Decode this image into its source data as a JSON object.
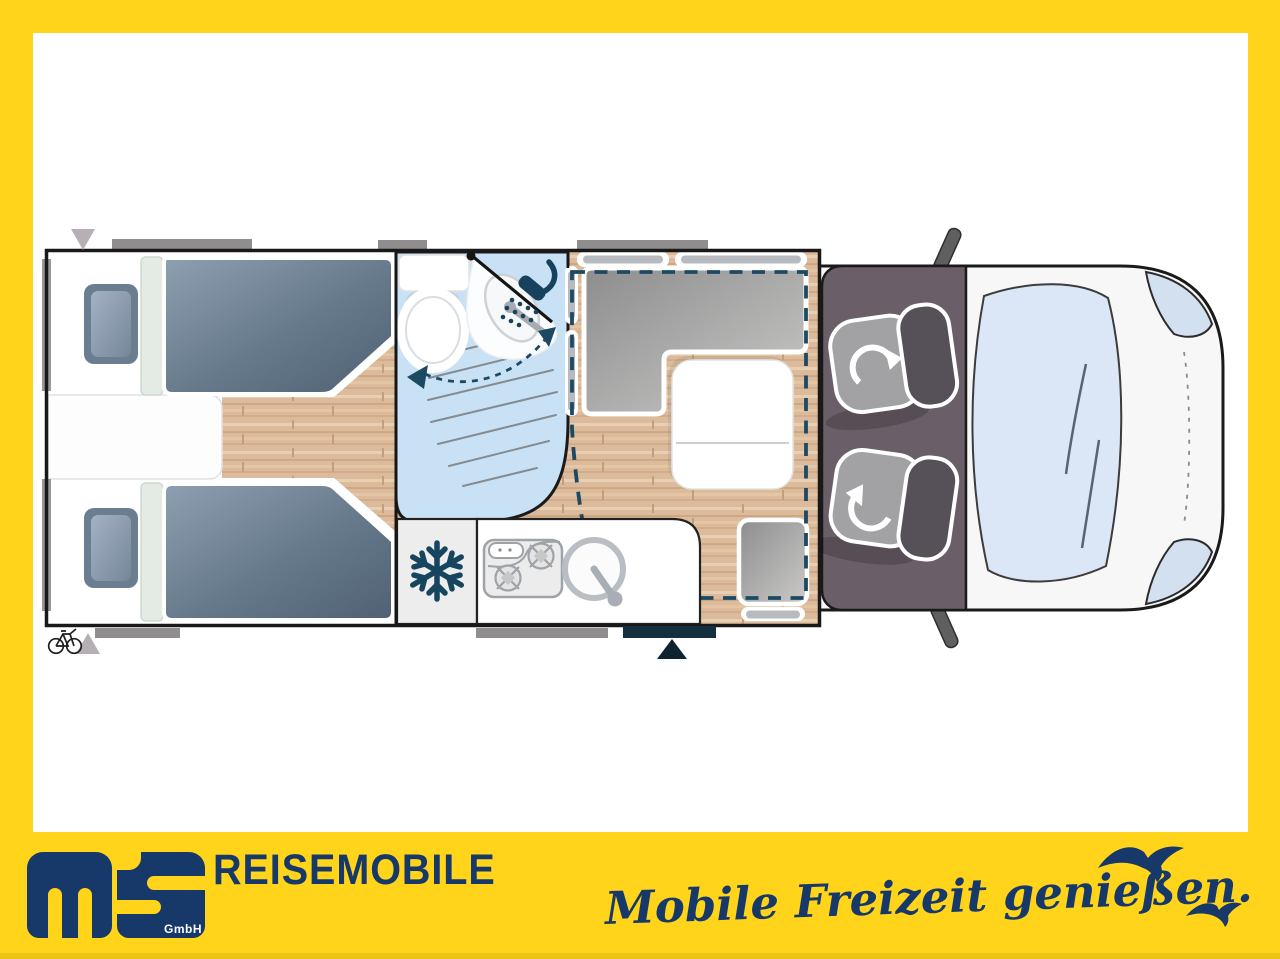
{
  "branding": {
    "company": "REISEMOBILE",
    "logo_sub": "GmbH",
    "tagline": "Mobile Freizeit genießen."
  },
  "colors": {
    "frame_yellow": "#FFD41A",
    "brand_navy": "#16396A",
    "plan_navy": "#1D4A63",
    "wood_floor": "#DCBB9C",
    "bath_blue": "#C9E1F5",
    "mattress_gray_blue": "#76889B",
    "cab_floor": "#6A5F68",
    "cushion_gray": "#9C9C9C",
    "window_bar_gray": "#8F8D8E",
    "body_white": "#FFFFFF"
  },
  "floorplan": {
    "view": "top-down motorhome layout drawing",
    "zones": [
      {
        "name": "rear-bedroom",
        "items": [
          "twin-bed-top",
          "twin-bed-bottom",
          "pillows",
          "center-step"
        ]
      },
      {
        "name": "bathroom",
        "items": [
          "toilet",
          "swivel-washbasin",
          "shower-head",
          "swivel-arrows"
        ]
      },
      {
        "name": "dinette",
        "items": [
          "l-shaped-bench",
          "folding-table",
          "side-bench",
          "drop-down-bed-dashed-outline"
        ]
      },
      {
        "name": "kitchen",
        "items": [
          "fridge-snowflake",
          "two-burner-hob",
          "round-sink"
        ]
      },
      {
        "name": "cab",
        "items": [
          "driver-swivel-seat",
          "passenger-swivel-seat",
          "windshield",
          "headlights",
          "mirrors"
        ]
      },
      {
        "name": "exterior",
        "items": [
          "entry-door",
          "entry-arrow",
          "bike-rack",
          "rear-markers",
          "window-bars"
        ]
      }
    ]
  }
}
